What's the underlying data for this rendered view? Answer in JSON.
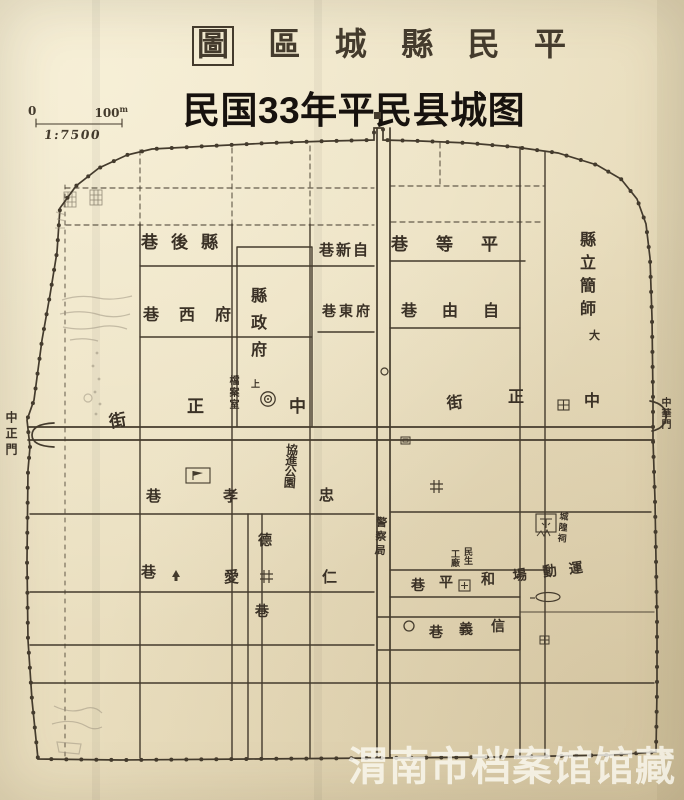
{
  "colors": {
    "paper": "#eadfc0",
    "ink": "#443b2d",
    "label_ink": "#3a3126",
    "pencil": "#978e7c",
    "subtitle_ink": "#17120e",
    "watermark": "rgba(253,251,243,0.78)"
  },
  "title": {
    "chars": [
      "圖",
      "區",
      "城",
      "縣",
      "民",
      "平"
    ]
  },
  "subtitle": "民国33年平民县城图",
  "scale": {
    "zero": "0",
    "distance": "100",
    "unit": "m",
    "ratio": "1:7500"
  },
  "watermark": "渭南市档案馆馆藏",
  "map": {
    "labels": [
      {
        "text": "巷後縣",
        "x": 141,
        "y": 235,
        "size": 17,
        "ls": 13
      },
      {
        "text": "巷新自",
        "x": 319,
        "y": 243,
        "size": 15,
        "ls": 2
      },
      {
        "text": "巷等平",
        "x": 391,
        "y": 237,
        "size": 17,
        "ls": 28
      },
      {
        "text": "縣立簡師",
        "x": 578,
        "y": 231,
        "size": 16,
        "dir": "v",
        "ls": 7
      },
      {
        "text": "大",
        "x": 589,
        "y": 330,
        "size": 11
      },
      {
        "text": "巷西府",
        "x": 143,
        "y": 307,
        "size": 16,
        "ls": 20
      },
      {
        "text": "縣政府",
        "x": 249,
        "y": 287,
        "size": 16,
        "dir": "v",
        "ls": 11
      },
      {
        "text": "巷東府",
        "x": 322,
        "y": 305,
        "size": 14,
        "ls": 3
      },
      {
        "text": "巷由自",
        "x": 401,
        "y": 303,
        "size": 16,
        "ls": 25
      },
      {
        "text": "街",
        "x": 108,
        "y": 415,
        "size": 17,
        "rot": -10
      },
      {
        "text": "正",
        "x": 187,
        "y": 399,
        "size": 17
      },
      {
        "text": "檔案室",
        "x": 227,
        "y": 375,
        "size": 10,
        "dir": "v",
        "ls": 2
      },
      {
        "text": "上",
        "x": 251,
        "y": 381,
        "size": 9
      },
      {
        "text": "中",
        "x": 289,
        "y": 399,
        "size": 17
      },
      {
        "text": "街",
        "x": 446,
        "y": 396,
        "size": 16,
        "rot": -6
      },
      {
        "text": "正",
        "x": 508,
        "y": 389,
        "size": 16
      },
      {
        "text": "中",
        "x": 584,
        "y": 393,
        "size": 16
      },
      {
        "text": "中正門",
        "x": 5,
        "y": 411,
        "size": 12,
        "dir": "v",
        "ls": 4
      },
      {
        "text": "中華門",
        "x": 659,
        "y": 397,
        "size": 10,
        "dir": "v",
        "ls": 1
      },
      {
        "text": "巷",
        "x": 146,
        "y": 489,
        "size": 15
      },
      {
        "text": "孝",
        "x": 223,
        "y": 489,
        "size": 15
      },
      {
        "text": "忠",
        "x": 319,
        "y": 488,
        "size": 15
      },
      {
        "text": "協進公園",
        "x": 286,
        "y": 443,
        "size": 12,
        "dir": "v",
        "ls": -1,
        "rot": 4
      },
      {
        "text": "德",
        "x": 258,
        "y": 534,
        "size": 14
      },
      {
        "text": "巷",
        "x": 255,
        "y": 605,
        "size": 14
      },
      {
        "text": "巷",
        "x": 141,
        "y": 565,
        "size": 15
      },
      {
        "text": "愛",
        "x": 224,
        "y": 570,
        "size": 15
      },
      {
        "text": "仁",
        "x": 322,
        "y": 570,
        "size": 15
      },
      {
        "text": "警察局",
        "x": 376,
        "y": 516,
        "size": 11,
        "dir": "v",
        "ls": 3,
        "rot": 3
      },
      {
        "text": "民生",
        "x": 462,
        "y": 547,
        "size": 9,
        "dir": "v"
      },
      {
        "text": "工廠",
        "x": 449,
        "y": 549,
        "size": 9,
        "dir": "v"
      },
      {
        "text": "巷",
        "x": 411,
        "y": 579,
        "size": 14
      },
      {
        "text": "平",
        "x": 439,
        "y": 576,
        "size": 14
      },
      {
        "text": "和",
        "x": 481,
        "y": 573,
        "size": 14
      },
      {
        "text": "場",
        "x": 512,
        "y": 570,
        "size": 14,
        "rot": -8
      },
      {
        "text": "動",
        "x": 542,
        "y": 566,
        "size": 14,
        "rot": -8
      },
      {
        "text": "運",
        "x": 568,
        "y": 563,
        "size": 14,
        "rot": -8
      },
      {
        "text": "城隍祠",
        "x": 558,
        "y": 511,
        "size": 9,
        "dir": "v",
        "ls": 2,
        "rot": 5
      },
      {
        "text": "巷",
        "x": 429,
        "y": 626,
        "size": 14
      },
      {
        "text": "義",
        "x": 459,
        "y": 623,
        "size": 14
      },
      {
        "text": "信",
        "x": 491,
        "y": 620,
        "size": 14
      }
    ],
    "symbols": [
      {
        "name": "government-seat-marker",
        "sym": "concentric",
        "x": 260,
        "y": 391
      },
      {
        "name": "street-box-marker",
        "sym": "box-grid",
        "x": 558,
        "y": 400
      },
      {
        "name": "school-flag-marker",
        "sym": "box-flag",
        "x": 186,
        "y": 468
      },
      {
        "name": "temple-box-marker",
        "sym": "box-temple",
        "x": 536,
        "y": 514
      },
      {
        "name": "post-box-marker",
        "sym": "box-plus",
        "x": 459,
        "y": 580
      },
      {
        "name": "building-box-marker",
        "sym": "box-inner",
        "x": 401,
        "y": 437
      },
      {
        "name": "cross-box-marker",
        "sym": "box-cross",
        "x": 540,
        "y": 636
      },
      {
        "name": "well-marker",
        "sym": "well",
        "x": 260,
        "y": 570
      },
      {
        "name": "well-marker",
        "sym": "well",
        "x": 430,
        "y": 480
      },
      {
        "name": "circle-marker",
        "sym": "circle-m",
        "x": 404,
        "y": 621
      },
      {
        "name": "circle-marker",
        "sym": "circle-s",
        "x": 381,
        "y": 368
      },
      {
        "name": "running-track-marker",
        "sym": "track",
        "x": 534,
        "y": 590
      },
      {
        "name": "house-marker",
        "sym": "house",
        "x": 172,
        "y": 569
      },
      {
        "name": "north-gate-dot",
        "sym": "gate-dot",
        "x": 374,
        "y": 112
      },
      {
        "name": "hatch-marker",
        "sym": "hatch",
        "x": 64,
        "y": 192
      },
      {
        "name": "hatch-marker",
        "sym": "hatch",
        "x": 90,
        "y": 190
      }
    ]
  }
}
